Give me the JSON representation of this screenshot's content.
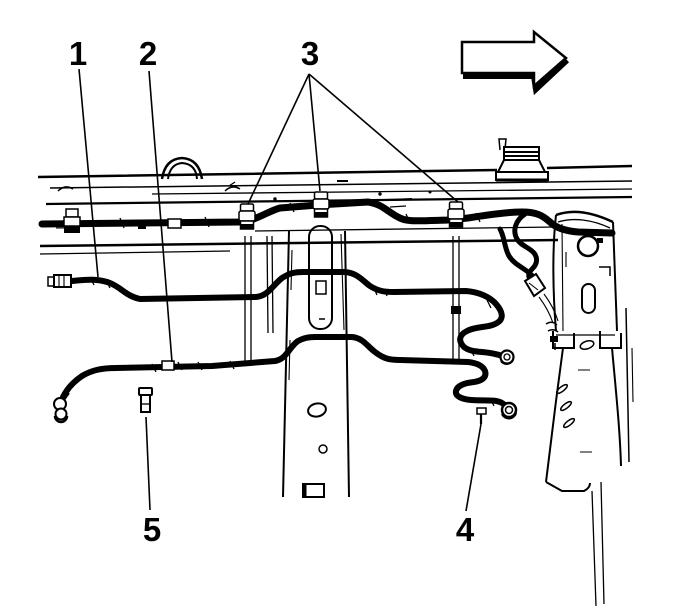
{
  "figure": {
    "kind": "service-manual line illustration",
    "subject": "frame rail with fuel lines, clips and brackets",
    "background_color": "#ffffff",
    "line_color": "#000000"
  },
  "direction_arrow": {
    "icon": "front-direction-arrow",
    "points": "right"
  },
  "callouts": [
    {
      "label": "1",
      "label_x": 78,
      "label_y": 65,
      "leaders": [
        [
          [
            79,
            69
          ],
          [
            98,
            277
          ]
        ]
      ]
    },
    {
      "label": "2",
      "label_x": 148,
      "label_y": 65,
      "leaders": [
        [
          [
            149,
            71
          ],
          [
            172,
            362
          ]
        ]
      ]
    },
    {
      "label": "3",
      "label_x": 310,
      "label_y": 65,
      "leaders": [
        [
          [
            309,
            74
          ],
          [
            248,
            204
          ]
        ],
        [
          [
            309,
            74
          ],
          [
            320,
            191
          ]
        ],
        [
          [
            309,
            74
          ],
          [
            458,
            202
          ]
        ]
      ]
    },
    {
      "label": "4",
      "label_x": 465,
      "label_y": 541,
      "leaders": [
        [
          [
            466,
            511
          ],
          [
            481,
            424
          ]
        ]
      ]
    },
    {
      "label": "5",
      "label_x": 152,
      "label_y": 541,
      "leaders": [
        [
          [
            150,
            510
          ],
          [
            146,
            417
          ]
        ]
      ]
    }
  ]
}
